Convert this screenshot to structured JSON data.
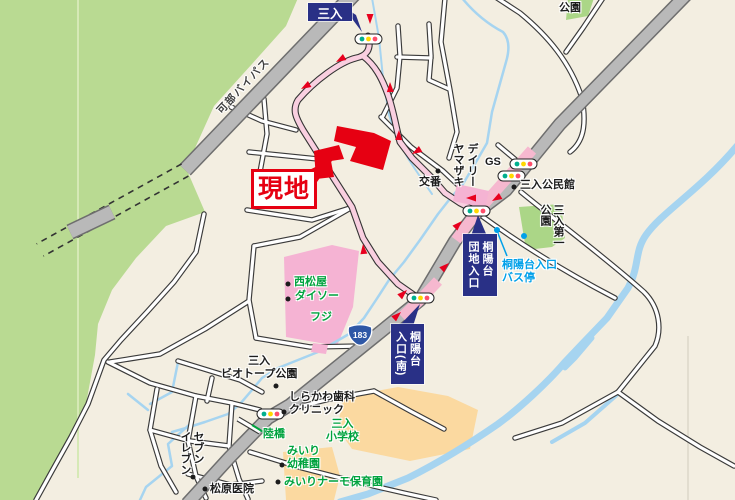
{
  "map": {
    "labels": {
      "miiri": {
        "text": "三入"
      },
      "kabe_bypass": {
        "text": "可部バイパス"
      },
      "genchi": {
        "text": "現地"
      },
      "koban": {
        "text": "交番"
      },
      "daily_yamazaki": {
        "text": "デイリー\nヤマザキ"
      },
      "gs": {
        "text": "GS"
      },
      "kominkan": {
        "text": "三入公民館"
      },
      "park_top": {
        "text": "公園"
      },
      "park_first": {
        "text": "三入第一\n公園"
      },
      "bus_stop": {
        "text": "桐陽台入口\nバス停"
      },
      "danchi_entrance": {
        "text": "桐陽台\n団地入口"
      },
      "minami_entrance": {
        "text": "桐陽台\n入口(南)"
      },
      "nishimatsuya": {
        "text": "西松屋"
      },
      "daiso": {
        "text": "ダイソー"
      },
      "fuji": {
        "text": "フジ"
      },
      "route_badge": {
        "text": "183"
      },
      "biotope_park": {
        "text": "三入\nビオトープ公園"
      },
      "shirakawa_dental": {
        "text": "しらかわ歯科\nクリニック"
      },
      "rikkyo": {
        "text": "陸橋"
      },
      "elementary_school": {
        "text": "三入\n小学校"
      },
      "kindergarten": {
        "text": "みいり\n幼稚園"
      },
      "nursery": {
        "text": "みいりナーモ保育園"
      },
      "seven_eleven": {
        "text": "セブン\nイレブン"
      },
      "matsubara_clinic": {
        "text": "松原医院"
      }
    },
    "colors": {
      "background_beige": "#f3eee1",
      "hill_green": "#b9da92",
      "park_green": "#abd687",
      "water_blue": "#a6d4f0",
      "road_gray": "#b9b9b9",
      "route_pink": "#f9cfe0",
      "shop_pink": "#f5b3d3",
      "school_orange": "#fbd9a0",
      "site_red": "#e60012",
      "arrow_red": "#e8001e",
      "label_green": "#00a33e",
      "label_cyan": "#00a0e9",
      "box_navy": "#293086",
      "signal_teal": "#00af8e",
      "signal_yellow": "#ffd800",
      "signal_red": "#ff4e6a"
    },
    "signals": [
      "三入",
      "三入公民館北",
      "三入公民館南",
      "桐陽台団地入口",
      "桐陽台入口(南)",
      "しらかわ歯科前"
    ],
    "bus_stop_marks": 2
  }
}
